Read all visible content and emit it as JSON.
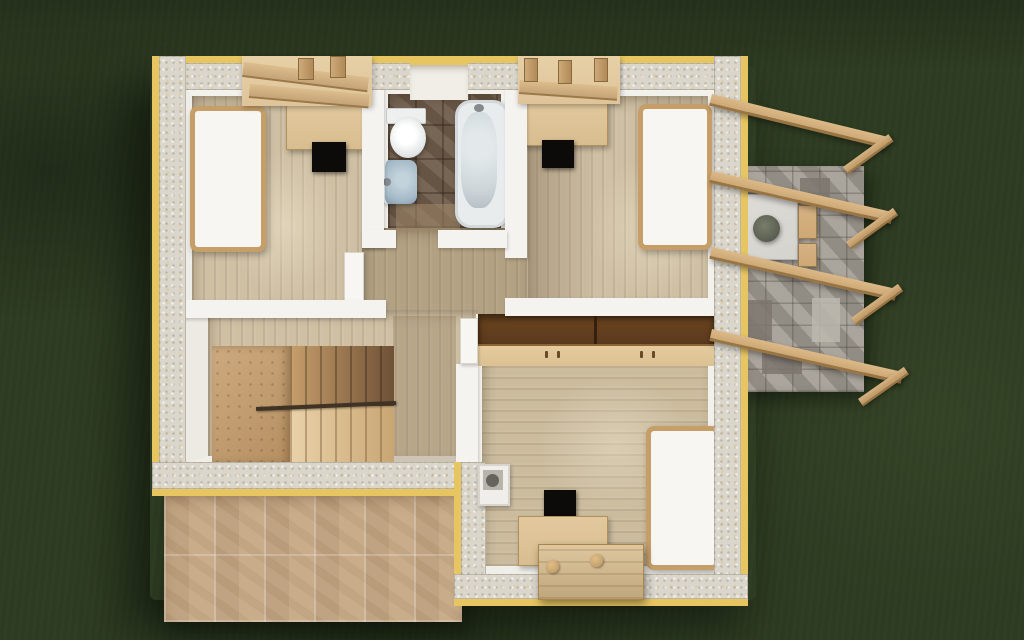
{
  "scene": {
    "type": "3d-architectural-floorplan-render",
    "view": "top-down overhead",
    "setting": "Upper floor of a house with two top bedrooms, central bathroom, staircase, large bottom bedroom, stone terrace with timber pergola, beige tiled patio and dark green lawn",
    "visible_text": ""
  },
  "colors": {
    "grass": "#2d3b22",
    "wallTop": "#dad6cc",
    "edge": "#e7c661",
    "inWall": "#f4f3ef",
    "wood": "#cfc0a4",
    "woodR5": "#cbbc9e",
    "walkway": "#b2a183",
    "bathTile": "#6f5c4a",
    "mattress": "#f7f6f2",
    "bedFrame": "#c69f68",
    "desk": "#d8bd90",
    "chair": "#0d0b09",
    "wardTop": "#5c3a1f",
    "wardDoors": "#dcc193",
    "sink": "#a3b8c6",
    "tubInner": "#ccd4d8",
    "stone": "#a19b91",
    "stoneLight": "#bcb7ae",
    "stoneDark": "#7c766e",
    "pergola": "#cda975",
    "pergolaEdge": "#9a7544",
    "patio": "#c9ae8e",
    "stoop": "#d9bd8e",
    "knob": "#c7a26b",
    "tableTop": "#d5d3ce",
    "plant": "#5c6052",
    "handrail": "#3f3326",
    "dormer": "#dfc49a",
    "chimTop": "#b7b4ac",
    "chimHole": "#66635c"
  },
  "house": {
    "rooms": [
      {
        "id": "bedroom-top-left",
        "furniture": [
          "single bed",
          "desk under dormer",
          "black chair"
        ]
      },
      {
        "id": "bathroom",
        "furniture": [
          "toilet",
          "washbasin",
          "bathtub"
        ],
        "floor": "dark brown tile"
      },
      {
        "id": "bedroom-top-right",
        "furniture": [
          "single bed",
          "desk under dormer",
          "black chair"
        ]
      },
      {
        "id": "hallway",
        "furniture": [
          "open door leaf"
        ]
      },
      {
        "id": "stair-room",
        "furniture": [
          "switchback staircase",
          "handrail"
        ]
      },
      {
        "id": "bedroom-bottom-right",
        "furniture": [
          "wardrobe with open top",
          "single bed",
          "desk",
          "black chair",
          "chimney flue",
          "wooden door stoop"
        ]
      }
    ],
    "features": [
      "dormer openings with roof purlins on top wall",
      "window niche above bathroom",
      "yellow-edged insulated wall tops"
    ]
  },
  "outdoor": {
    "lawn": "dark green grass",
    "terrace": {
      "material": "grey stone paving",
      "items": [
        "garden table",
        "potted plant",
        "wooden stools"
      ]
    },
    "pergola": {
      "beam_count": 4,
      "brace_count": 4,
      "material": "timber"
    },
    "patio": {
      "material": "beige stone tiles"
    }
  }
}
